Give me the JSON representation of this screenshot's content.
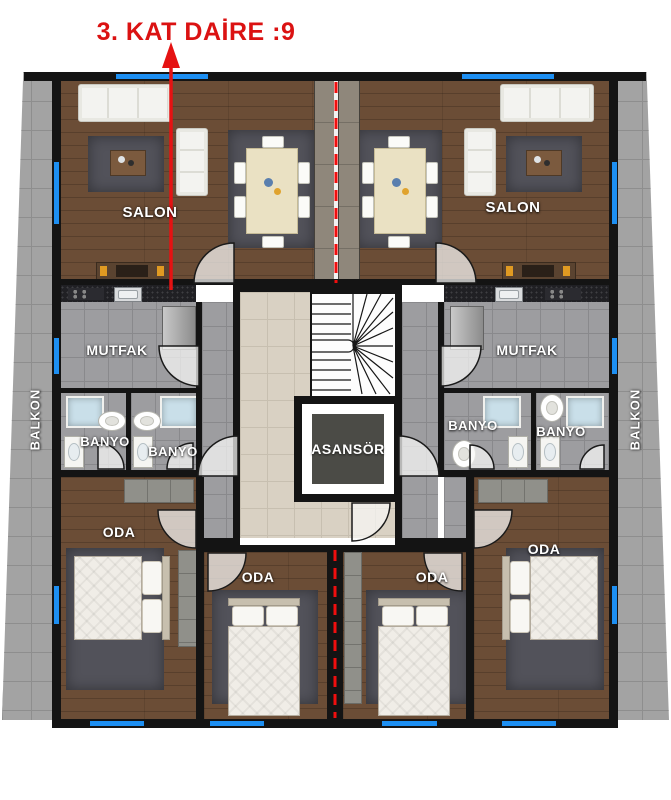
{
  "title": "3. KAT DAİRE :9",
  "labels": {
    "salon_left": "SALON",
    "salon_right": "SALON",
    "mutfak_left": "MUTFAK",
    "mutfak_right": "MUTFAK",
    "banyo_left_a": "BANYO",
    "banyo_left_b": "BANYO",
    "banyo_right_a": "BANYO",
    "banyo_right_b": "BANYO",
    "oda_outer_left": "ODA",
    "oda_center_left": "ODA",
    "oda_center_right": "ODA",
    "oda_outer_right": "ODA",
    "asansor": "ASANSÖR",
    "balkon_left": "BALKON",
    "balkon_right": "BALKON"
  },
  "colors": {
    "accent_red": "#db1212",
    "section_line_red": "#f10e0e",
    "window_blue": "#1d8ff2",
    "wall_black": "#141414",
    "wood_floor": "#6b4d36",
    "tile_gray": "#9d9da0",
    "tile_beige": "#d9d1c3",
    "rug_gray": "#52525a"
  }
}
